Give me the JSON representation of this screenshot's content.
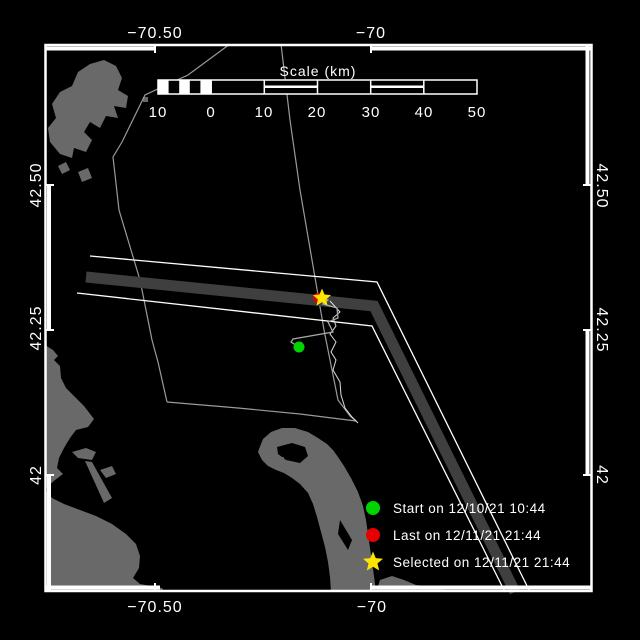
{
  "axis": {
    "lon": {
      "t1": "−70.50",
      "t2": "−70"
    },
    "lat": {
      "t1": "42.50",
      "t2": "42.25",
      "t3": "42"
    }
  },
  "scale_bar": {
    "title": "Scale (km)",
    "tick_labels": [
      "10",
      "0",
      "10",
      "20",
      "30",
      "40",
      "50"
    ]
  },
  "legend": {
    "start": {
      "marker": "green-circle",
      "label": "Start on 12/10/21 10:44"
    },
    "last": {
      "marker": "red-circle",
      "label": "Last on 12/11/21 21:44"
    },
    "selected": {
      "marker": "yellow-star",
      "label": "Selected on 12/11/21 21:44"
    }
  },
  "markers": {
    "start": {
      "shape": "circle",
      "color": "#00d400"
    },
    "last": {
      "shape": "circle",
      "color": "#e60000"
    },
    "selected": {
      "shape": "star",
      "color": "#ffe400"
    }
  },
  "colors": {
    "background": "#000000",
    "land": "#696969",
    "lane_zone": "#3f3f3f",
    "lane_edge": "#ffffff",
    "boundary_line": "#9a9a9a",
    "track": "#a8a8a8",
    "contour": "#dcdcdc",
    "frame": "#ffffff",
    "text": "#ffffff",
    "start_green": "#00d400",
    "last_red": "#e60000",
    "selected_yellow": "#ffe400"
  }
}
